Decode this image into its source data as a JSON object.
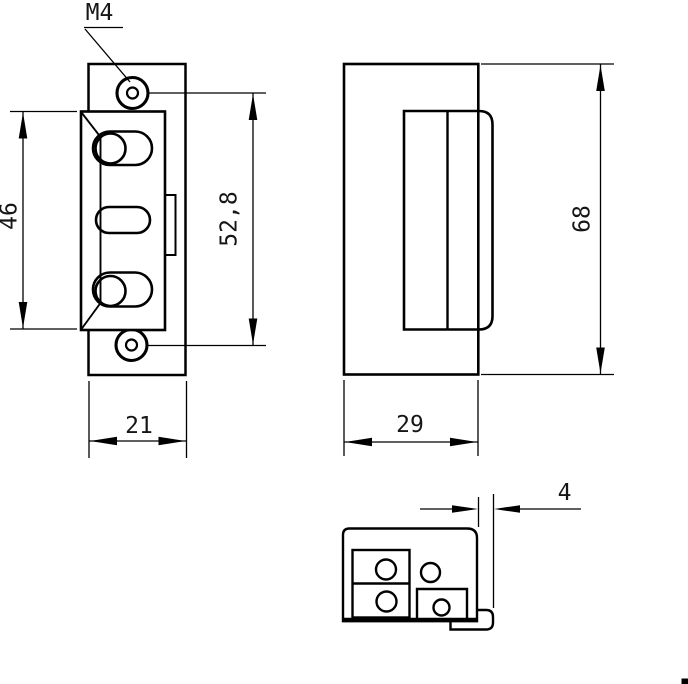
{
  "colors": {
    "background": "#ffffff",
    "line": "#000000",
    "text": "#161616"
  },
  "labels": {
    "thread": "M4",
    "front_body_height": "46",
    "front_screw_spacing": "52,8",
    "front_faceplate_width": "21",
    "side_height": "68",
    "side_depth": "29",
    "lip_offset": "4"
  }
}
